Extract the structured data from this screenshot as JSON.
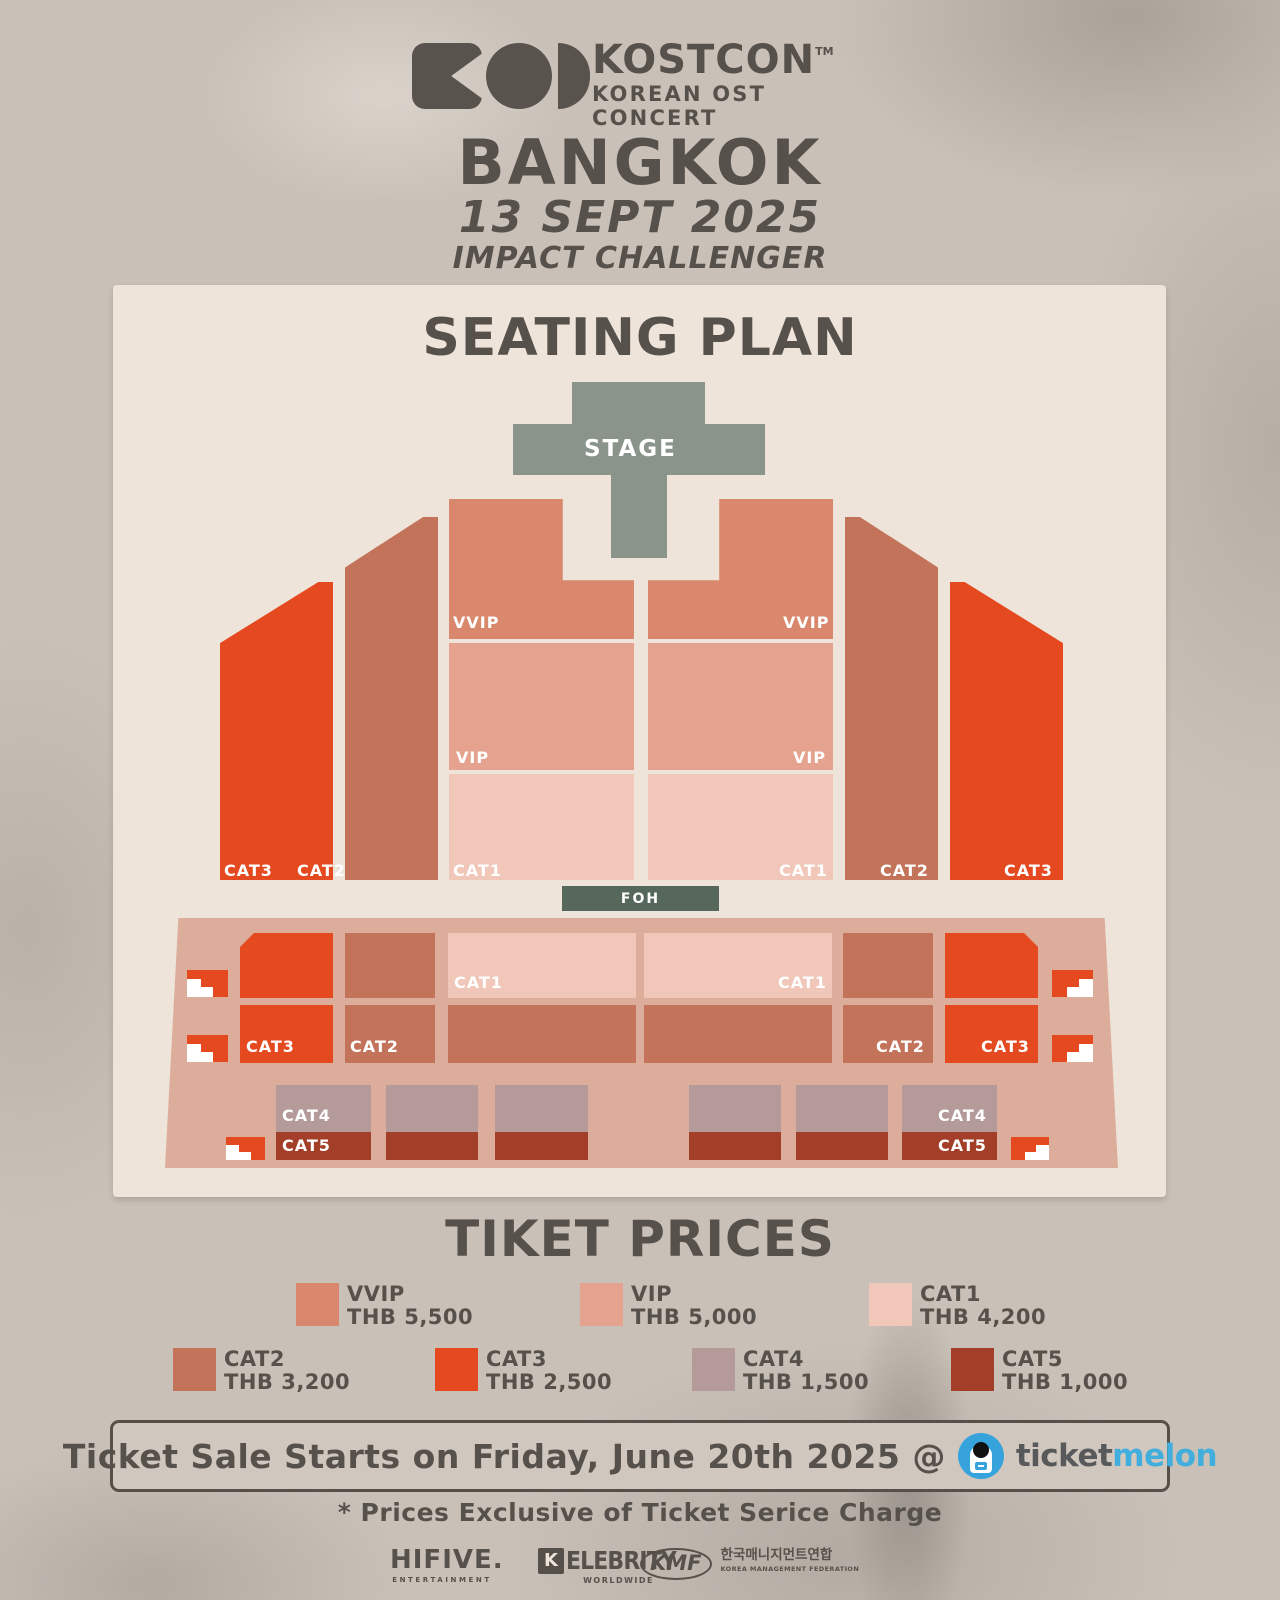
{
  "header": {
    "brand": "KOSTCON",
    "trademark": "TM",
    "tagline": "KOREAN OST CONCERT",
    "city": "BANGKOK",
    "date": "13 SEPT 2025",
    "venue": "IMPACT CHALLENGER"
  },
  "seating": {
    "title": "SEATING PLAN",
    "stage": "STAGE",
    "foh": "FOH",
    "labels": {
      "vvip": "VVIP",
      "vip": "VIP",
      "cat1": "CAT1",
      "cat2": "CAT2",
      "cat3": "CAT3",
      "cat4": "CAT4",
      "cat5": "CAT5"
    },
    "colors": {
      "stage": "#8a948b",
      "foh": "#55685b",
      "deck": "#ddad9b"
    }
  },
  "prices": {
    "title": "TIKET PRICES",
    "items": [
      {
        "label": "VVIP",
        "price": "THB 5,500",
        "color": "#d9886e"
      },
      {
        "label": "VIP",
        "price": "THB 5,000",
        "color": "#e4a28f"
      },
      {
        "label": "CAT1",
        "price": "THB 4,200",
        "color": "#f0c7b8"
      },
      {
        "label": "CAT2",
        "price": "THB 3,200",
        "color": "#c2735a"
      },
      {
        "label": "CAT3",
        "price": "THB 2,500",
        "color": "#e4491f"
      },
      {
        "label": "CAT4",
        "price": "THB 1,500",
        "color": "#b49b9a"
      },
      {
        "label": "CAT5",
        "price": "THB 1,000",
        "color": "#a33f28"
      }
    ]
  },
  "sale": {
    "text": "Ticket Sale Starts on Friday, June 20th 2025 @",
    "vendor_ticket": "ticket",
    "vendor_melon": "melon",
    "vendor_color_ticket": "#58595b",
    "vendor_color_melon": "#41aede"
  },
  "footnote": "* Prices Exclusive of Ticket Serice Charge",
  "footer": {
    "hifive": "HIFIVE.",
    "hifive_sub": "ENTERTAINMENT",
    "kelebrity_k": "K",
    "kelebrity": "ELEBRITY",
    "kelebrity_sub": "WORLDWIDE",
    "kmf": "KMF",
    "kmf_kr": "한국매니지먼트연합",
    "kmf_en": "KOREA MANAGEMENT FEDERATION"
  }
}
